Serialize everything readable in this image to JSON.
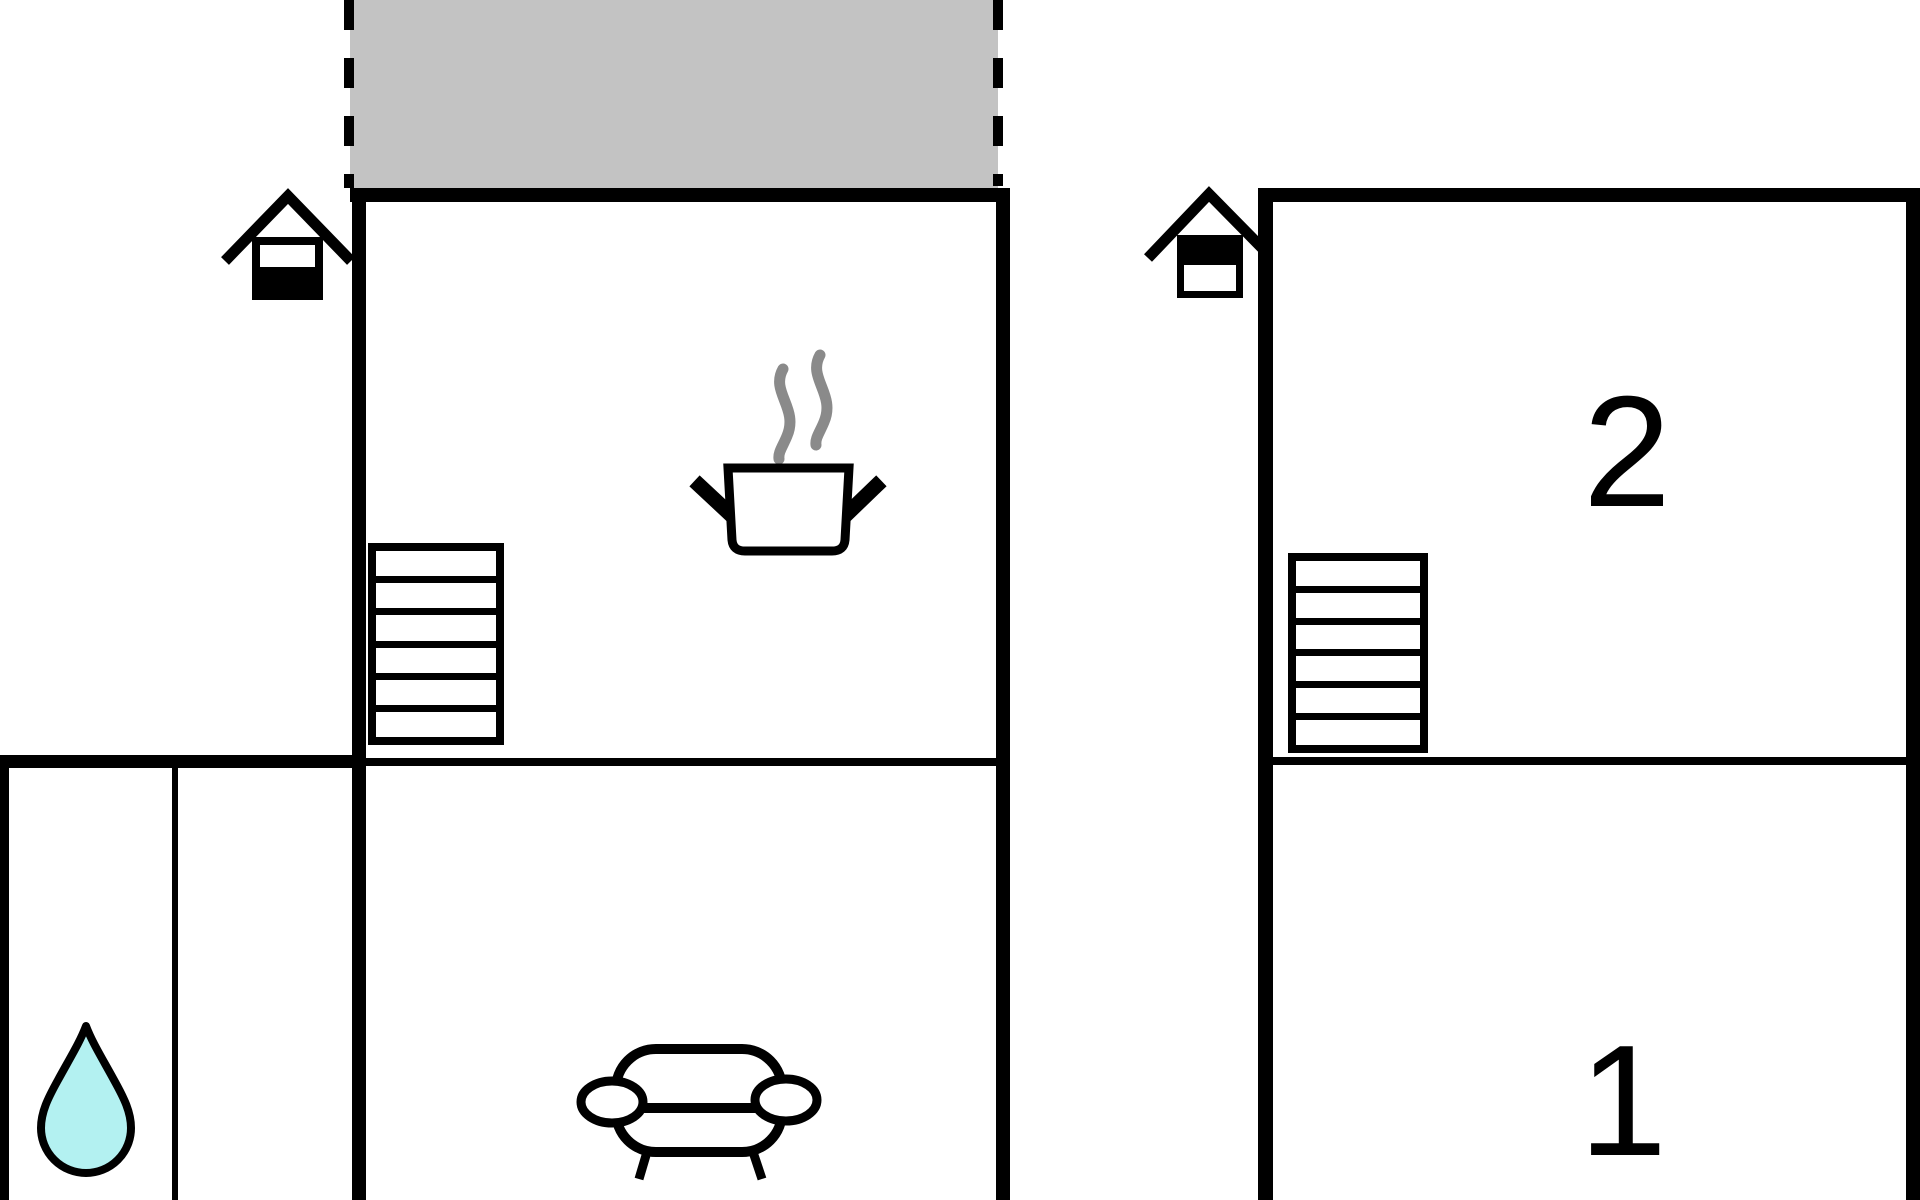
{
  "floorplan": {
    "kind": "vacation-house-floor-plan",
    "labels": {
      "room_1": "1",
      "room_2": "2"
    },
    "colors": {
      "wall": "#000000",
      "terrace": "#c3c3c3",
      "steam": "#8a8a8a",
      "water_drop": "#b3f1f1",
      "icon_fill": "#ffffff"
    },
    "icons": {
      "entrance_left": "entrance-house-icon",
      "entrance_right": "entrance-house-icon",
      "stairs_left": "stairs-icon",
      "stairs_right": "stairs-icon",
      "kitchen": "cooking-pot-icon",
      "living_room": "sofa-icon",
      "bathroom": "water-drop-icon",
      "terrace": "terrace-area"
    }
  }
}
